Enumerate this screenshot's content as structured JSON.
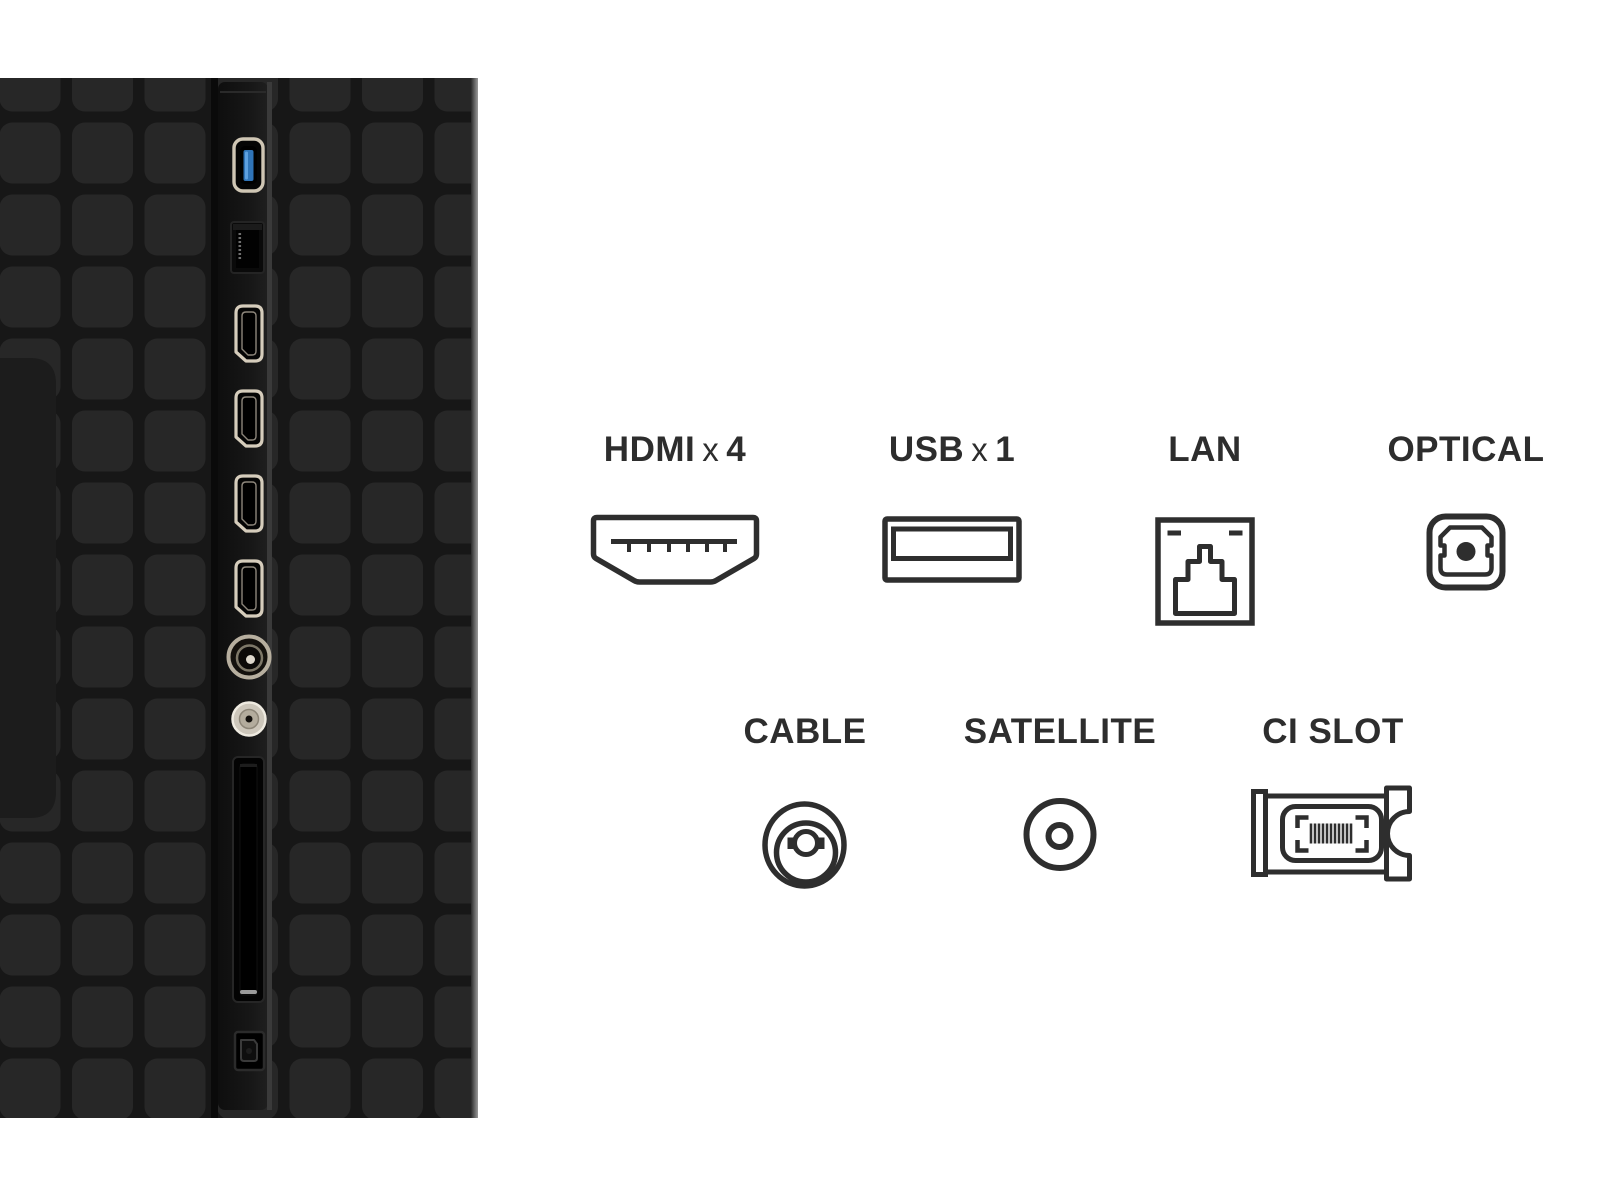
{
  "legend": {
    "items": [
      {
        "label": "HDMI",
        "times": "x",
        "qty": "4",
        "icon": "hdmi-connector-icon"
      },
      {
        "label": "USB",
        "times": "x",
        "qty": "1",
        "icon": "usb-connector-icon"
      },
      {
        "label": "LAN",
        "icon": "lan-rj45-icon"
      },
      {
        "label": "OPTICAL",
        "icon": "optical-toslink-icon"
      },
      {
        "label": "CABLE",
        "icon": "cable-coax-icon"
      },
      {
        "label": "SATELLITE",
        "icon": "satellite-f-connector-icon"
      },
      {
        "label": "CI SLOT",
        "icon": "ci-module-icon"
      }
    ]
  },
  "tv_panel": {
    "ports_top_to_bottom": [
      "usb-3.0-port",
      "lan-port",
      "hdmi-port-1",
      "hdmi-port-2",
      "hdmi-port-3",
      "hdmi-port-4",
      "cable-rf-port",
      "satellite-port",
      "ci-card-slot",
      "optical-audio-port"
    ]
  },
  "colors": {
    "background": "#ffffff",
    "label_text": "#2d2d2d",
    "icon_outline": "#2e2e2e",
    "panel_base": "#161616",
    "panel_tile": "#272727",
    "panel_strip": "#121212",
    "usb_blue": "#2f74b8",
    "connector_metal": "#cfc6b4"
  }
}
